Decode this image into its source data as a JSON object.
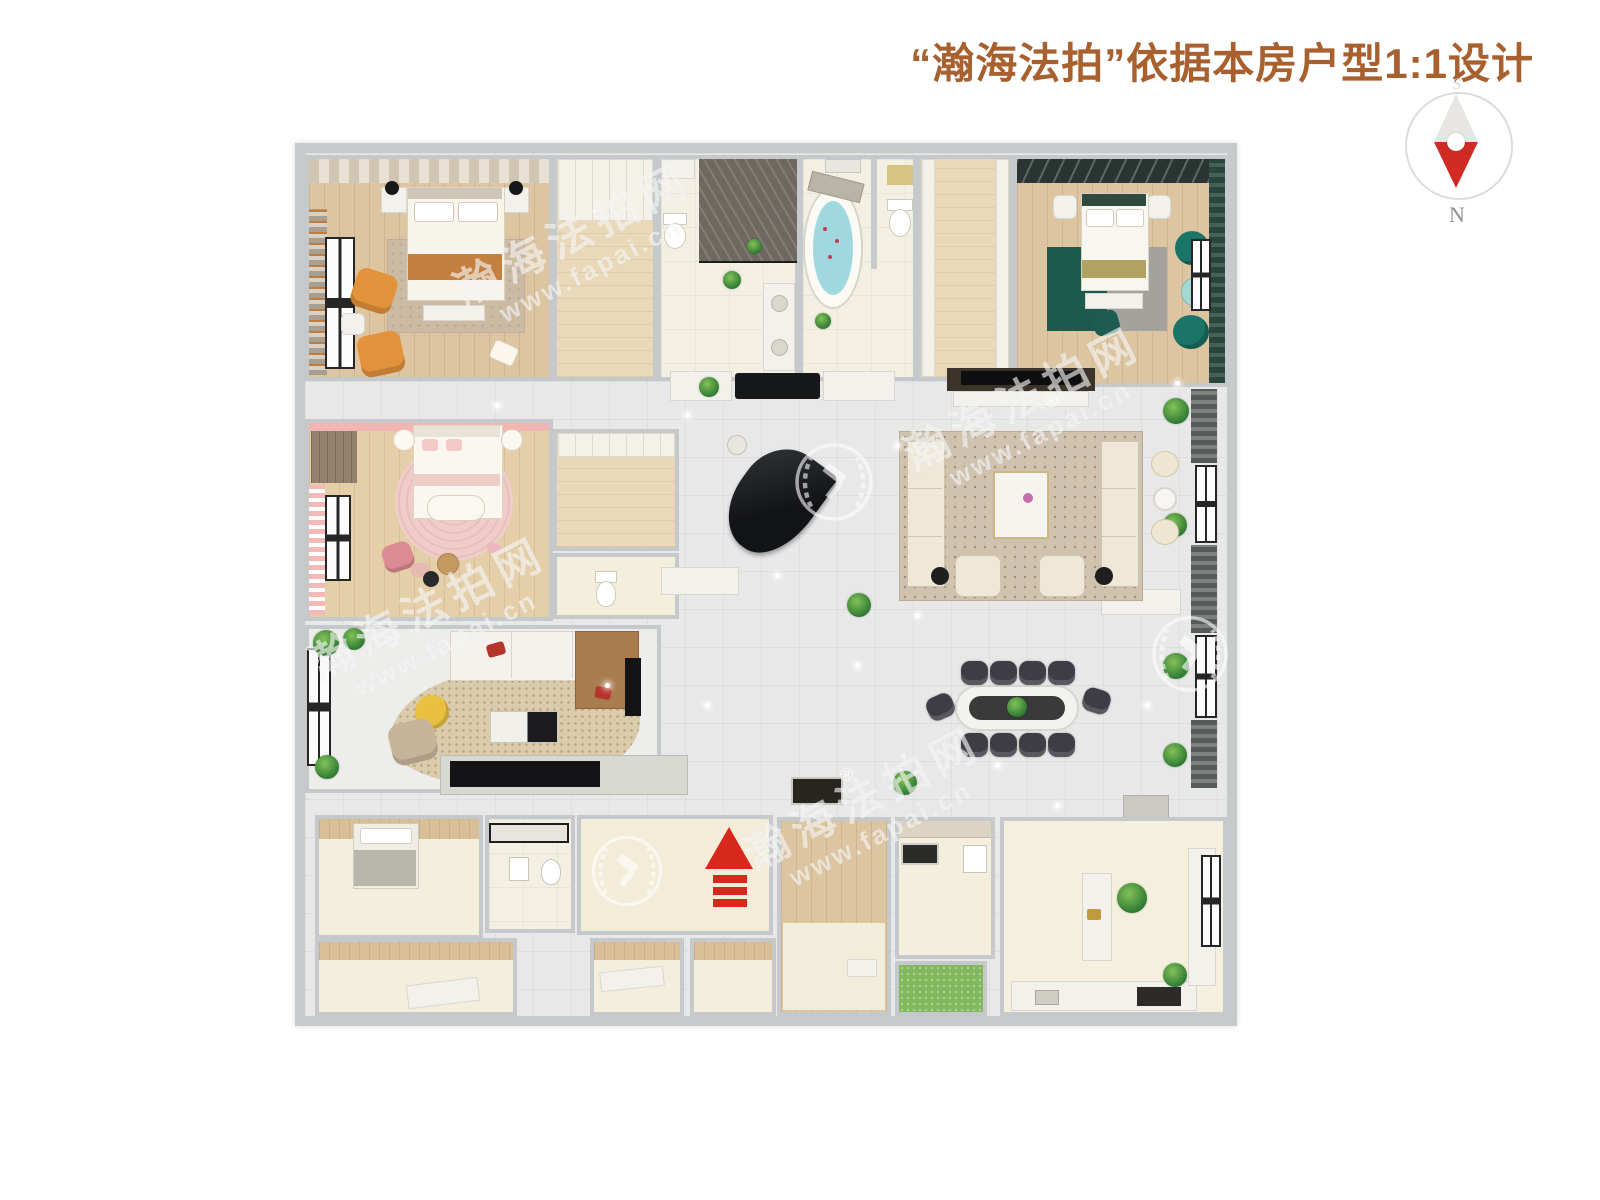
{
  "header": {
    "title": "“瀚海法拍”依据本房户型1:1设计"
  },
  "compass": {
    "north": "N",
    "south": "S"
  },
  "watermark": {
    "brand": "瀚海法拍网",
    "url": "www.fapai.cn",
    "registered": "®"
  },
  "colors": {
    "title_text": "#a9602f",
    "compass_needle_red": "#cf2b24",
    "outer_wall": "#c7cacb",
    "hall_tile": "#e7e8e7",
    "wood_floor": "#dcc5a0",
    "entrance_arrow_red": "#d8281e",
    "teal_rug": "#1d5a4e",
    "teal_chair": "#1a7568",
    "pink_rug": "#f0cdc9",
    "orange_armchair": "#e2933c",
    "grass_green": "#83b95e",
    "bathtub_water": "#9fd8df"
  }
}
